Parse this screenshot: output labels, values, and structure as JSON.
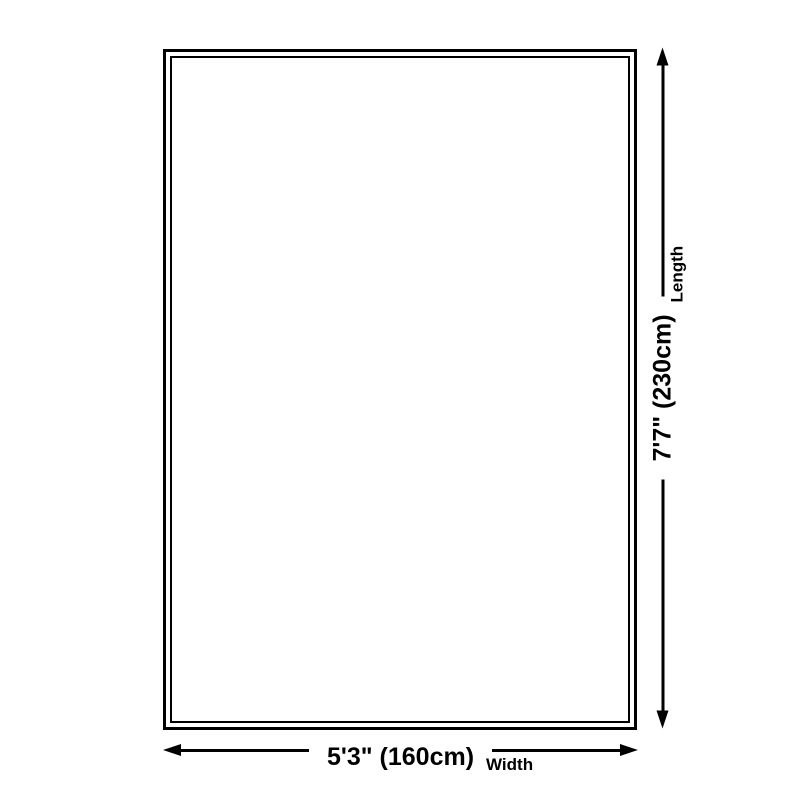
{
  "theme": {
    "line-color": "#000000",
    "background": "#ffffff"
  },
  "diagram": {
    "type": "product-size-diagram",
    "shape": "rectangle-double-border",
    "width": {
      "value": "5'3\" (160cm)",
      "label": "Width"
    },
    "length": {
      "value": "7'7\" (230cm)",
      "label": "Length"
    }
  }
}
